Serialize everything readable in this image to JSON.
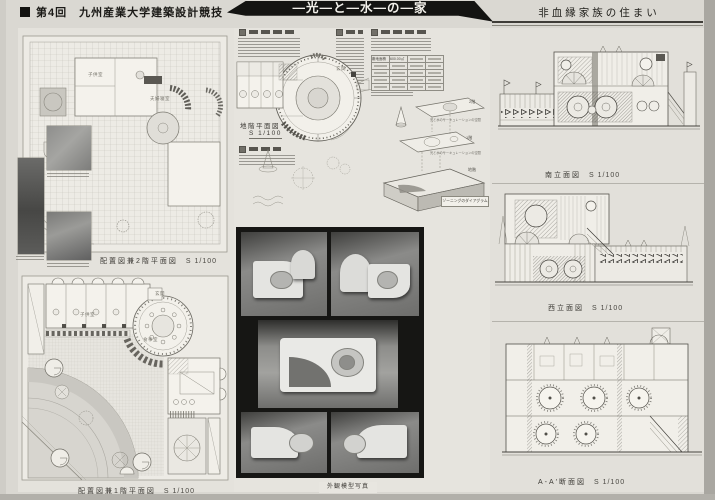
{
  "header": {
    "competition": "第4回　九州産業大学建築設計競技",
    "title": "―光―と―水―の―家",
    "subtitle": "非血縁家族の住まい"
  },
  "left_panel": {
    "upper_plan": {
      "label": "配置図兼2階平面図",
      "scale": "S 1/100",
      "rooms": [
        "子供室",
        "夫婦寝室"
      ]
    },
    "lower_plan": {
      "label": "配置図兼1階平面図",
      "scale": "S 1/100",
      "rooms": [
        "子供室",
        "玄関",
        "食事室"
      ]
    }
  },
  "center_panel": {
    "basement_plan": {
      "label": "地階平面図",
      "scale": "S 1/100",
      "rooms": [
        "玄関"
      ]
    },
    "area_table": {
      "first_row_label": "敷地面積",
      "first_row_value": "600.00㎡"
    },
    "axonometric": {
      "floors": [
        "2階",
        "1階",
        "地階"
      ],
      "annotation": "光と水のサーキュレーションの空間",
      "caption": "ゾーニングのダイアグラム"
    },
    "model_photos_caption": "外観模型写真"
  },
  "right_panel": {
    "drawings": [
      {
        "label": "南立面図",
        "scale": "S 1/100"
      },
      {
        "label": "西立面図",
        "scale": "S 1/100"
      },
      {
        "label": "A-A′断面図",
        "scale": "S 1/100"
      }
    ]
  },
  "colors": {
    "banner": "#141412",
    "photo_panel": "#161614",
    "paper": "#dad8d2"
  }
}
